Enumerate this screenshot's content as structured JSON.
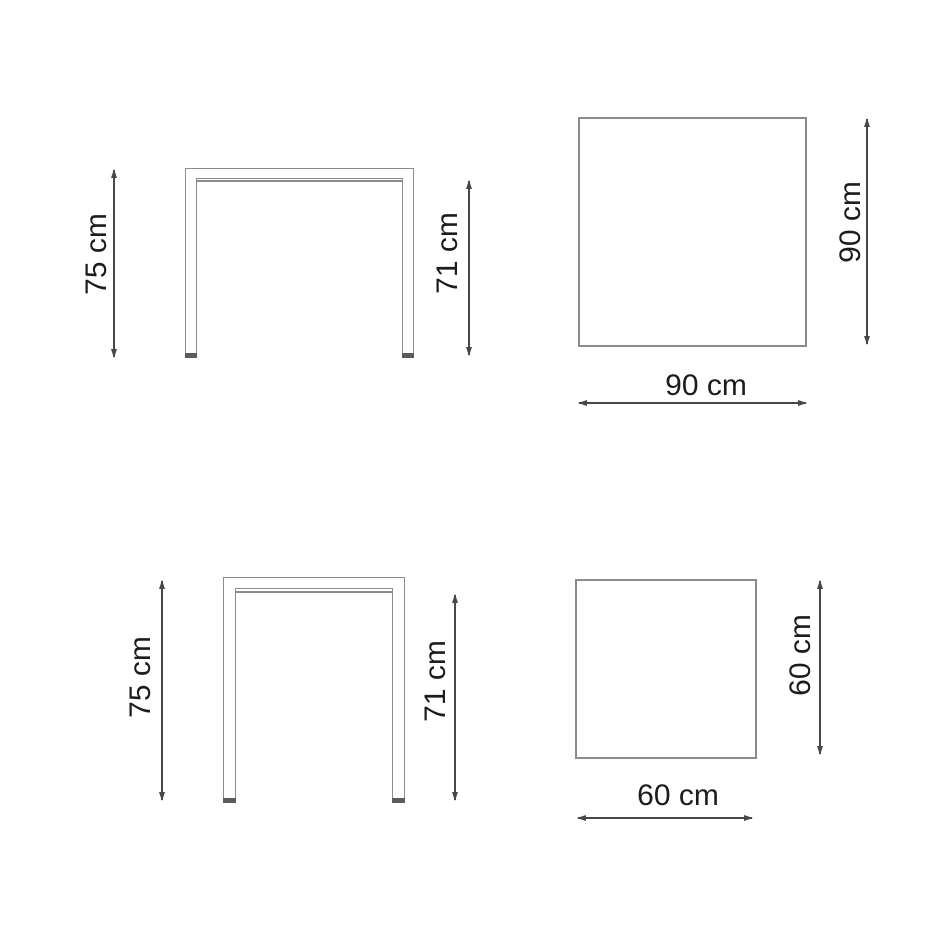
{
  "colors": {
    "outline": "#8c8c8c",
    "dim": "#474747",
    "text": "#1c1c1c",
    "foot": "#5c5c5c",
    "bg": "#ffffff"
  },
  "views": {
    "front_large": {
      "total_height_label": "75 cm",
      "under_top_height_label": "71 cm"
    },
    "top_large": {
      "depth_label": "90 cm",
      "width_label": "90 cm"
    },
    "front_small": {
      "total_height_label": "75 cm",
      "under_top_height_label": "71 cm"
    },
    "top_small": {
      "depth_label": "60 cm",
      "width_label": "60 cm"
    }
  }
}
